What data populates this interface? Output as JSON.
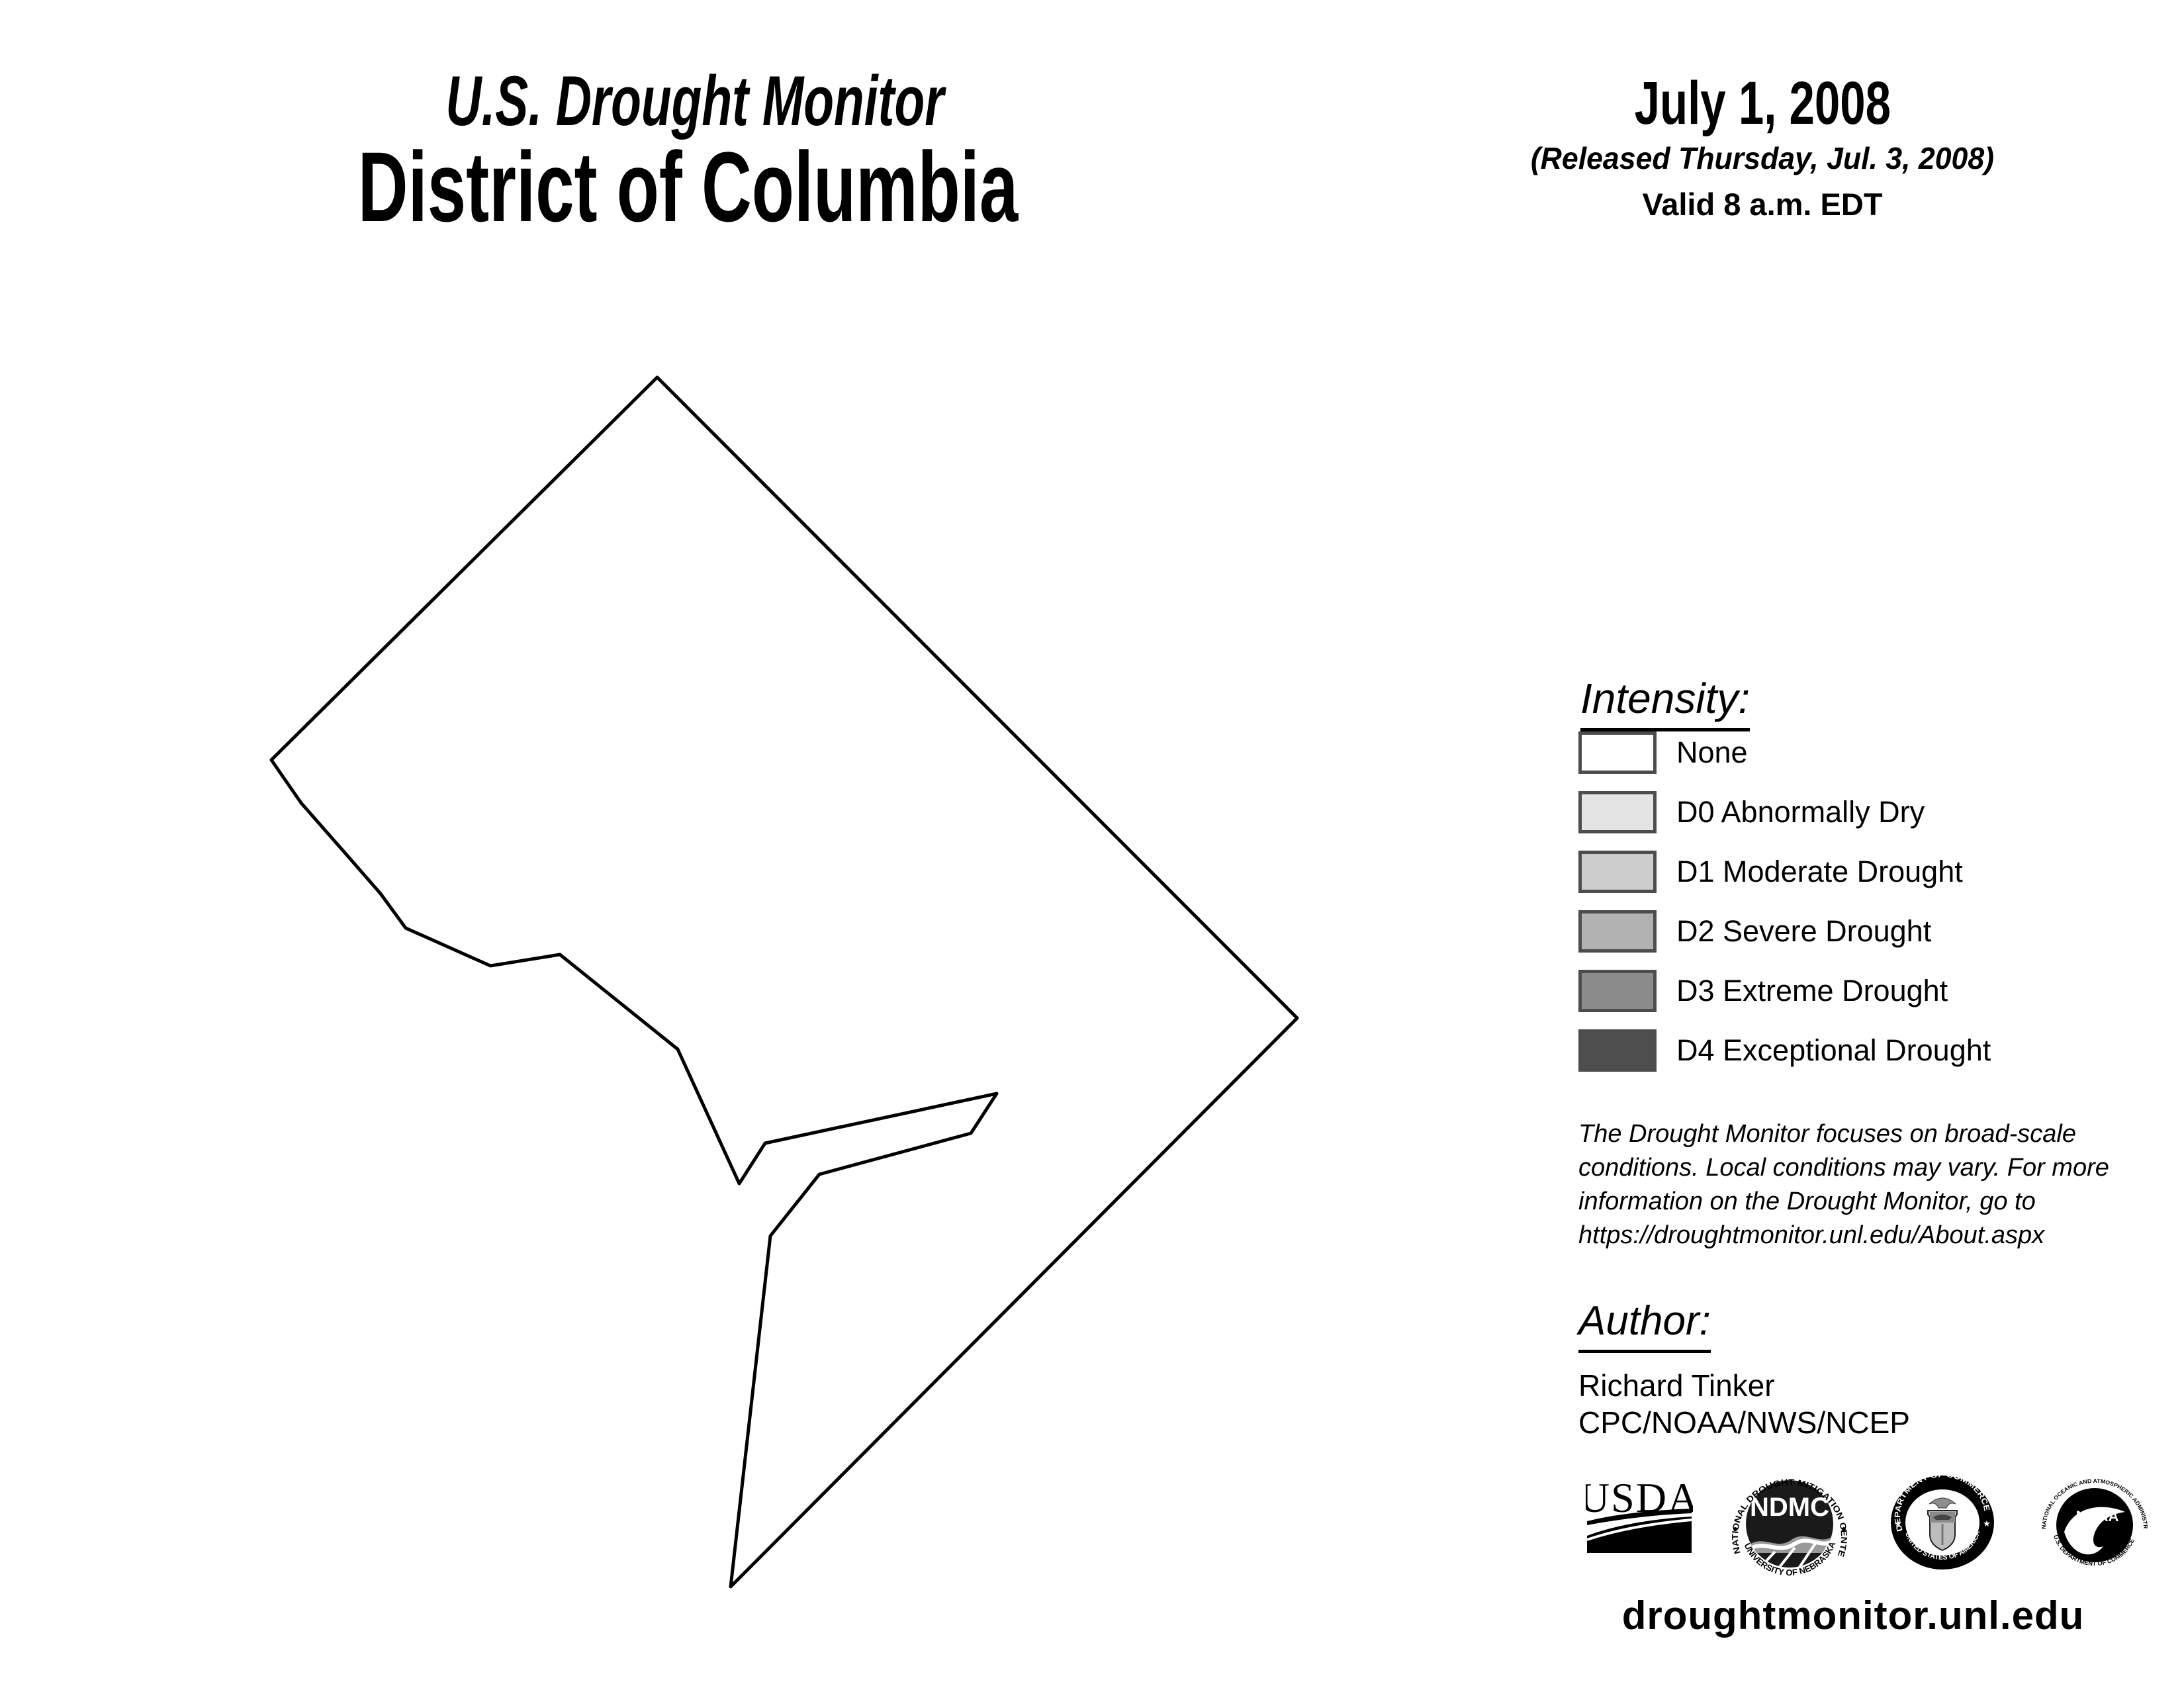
{
  "header": {
    "program_title": "U.S. Drought Monitor",
    "region_title": "District of Columbia",
    "date": "July 1, 2008",
    "released": "(Released Thursday, Jul. 3, 2008)",
    "valid": "Valid 8 a.m. EDT"
  },
  "map": {
    "region": "District of Columbia",
    "drought_status": "None",
    "fill": "#ffffff",
    "outline_color": "#000000",
    "outline_points": "993,570 1960,1538 1104,2397 1164,1867 1238,1774 1467,1712 1506,1652 1156,1727 1117,1788 1024,1585 846,1442 741,1459 613,1402 575,1350 520,1287 455,1213 410,1148"
  },
  "legend": {
    "heading": "Intensity:",
    "border_color": "#4d4d4d",
    "items": [
      {
        "label": "None",
        "color": "#ffffff"
      },
      {
        "label": "D0 Abnormally Dry",
        "color": "#e4e4e4"
      },
      {
        "label": "D1 Moderate Drought",
        "color": "#cdcdcd"
      },
      {
        "label": "D2 Severe Drought",
        "color": "#b1b1b1"
      },
      {
        "label": "D3 Extreme Drought",
        "color": "#8b8b8b"
      },
      {
        "label": "D4 Exceptional Drought",
        "color": "#4e4e4e"
      }
    ]
  },
  "disclaimer": {
    "lines": [
      "The Drought Monitor focuses on broad-scale",
      "conditions. Local conditions may vary. For more",
      "information on the Drought Monitor, go to",
      "https://droughtmonitor.unl.edu/About.aspx"
    ]
  },
  "author": {
    "heading": "Author:",
    "name": "Richard Tinker",
    "affiliation": "CPC/NOAA/NWS/NCEP"
  },
  "logos": {
    "usda": {
      "text": "USDA"
    },
    "ndmc": {
      "center": "NDMC",
      "top_arc": "NATIONAL DROUGHT MITIGATION CENTER",
      "bottom_arc": "UNIVERSITY OF NEBRASKA"
    },
    "doc": {
      "top_arc": "DEPARTMENT OF COMMERCE",
      "bottom_arc": "UNITED STATES OF AMERICA"
    },
    "noaa": {
      "center": "NOAA",
      "top_arc": "NATIONAL OCEANIC AND ATMOSPHERIC ADMINISTRATION",
      "bottom_arc": "U.S. DEPARTMENT OF COMMERCE"
    }
  },
  "footer": {
    "url": "droughtmonitor.unl.edu"
  }
}
